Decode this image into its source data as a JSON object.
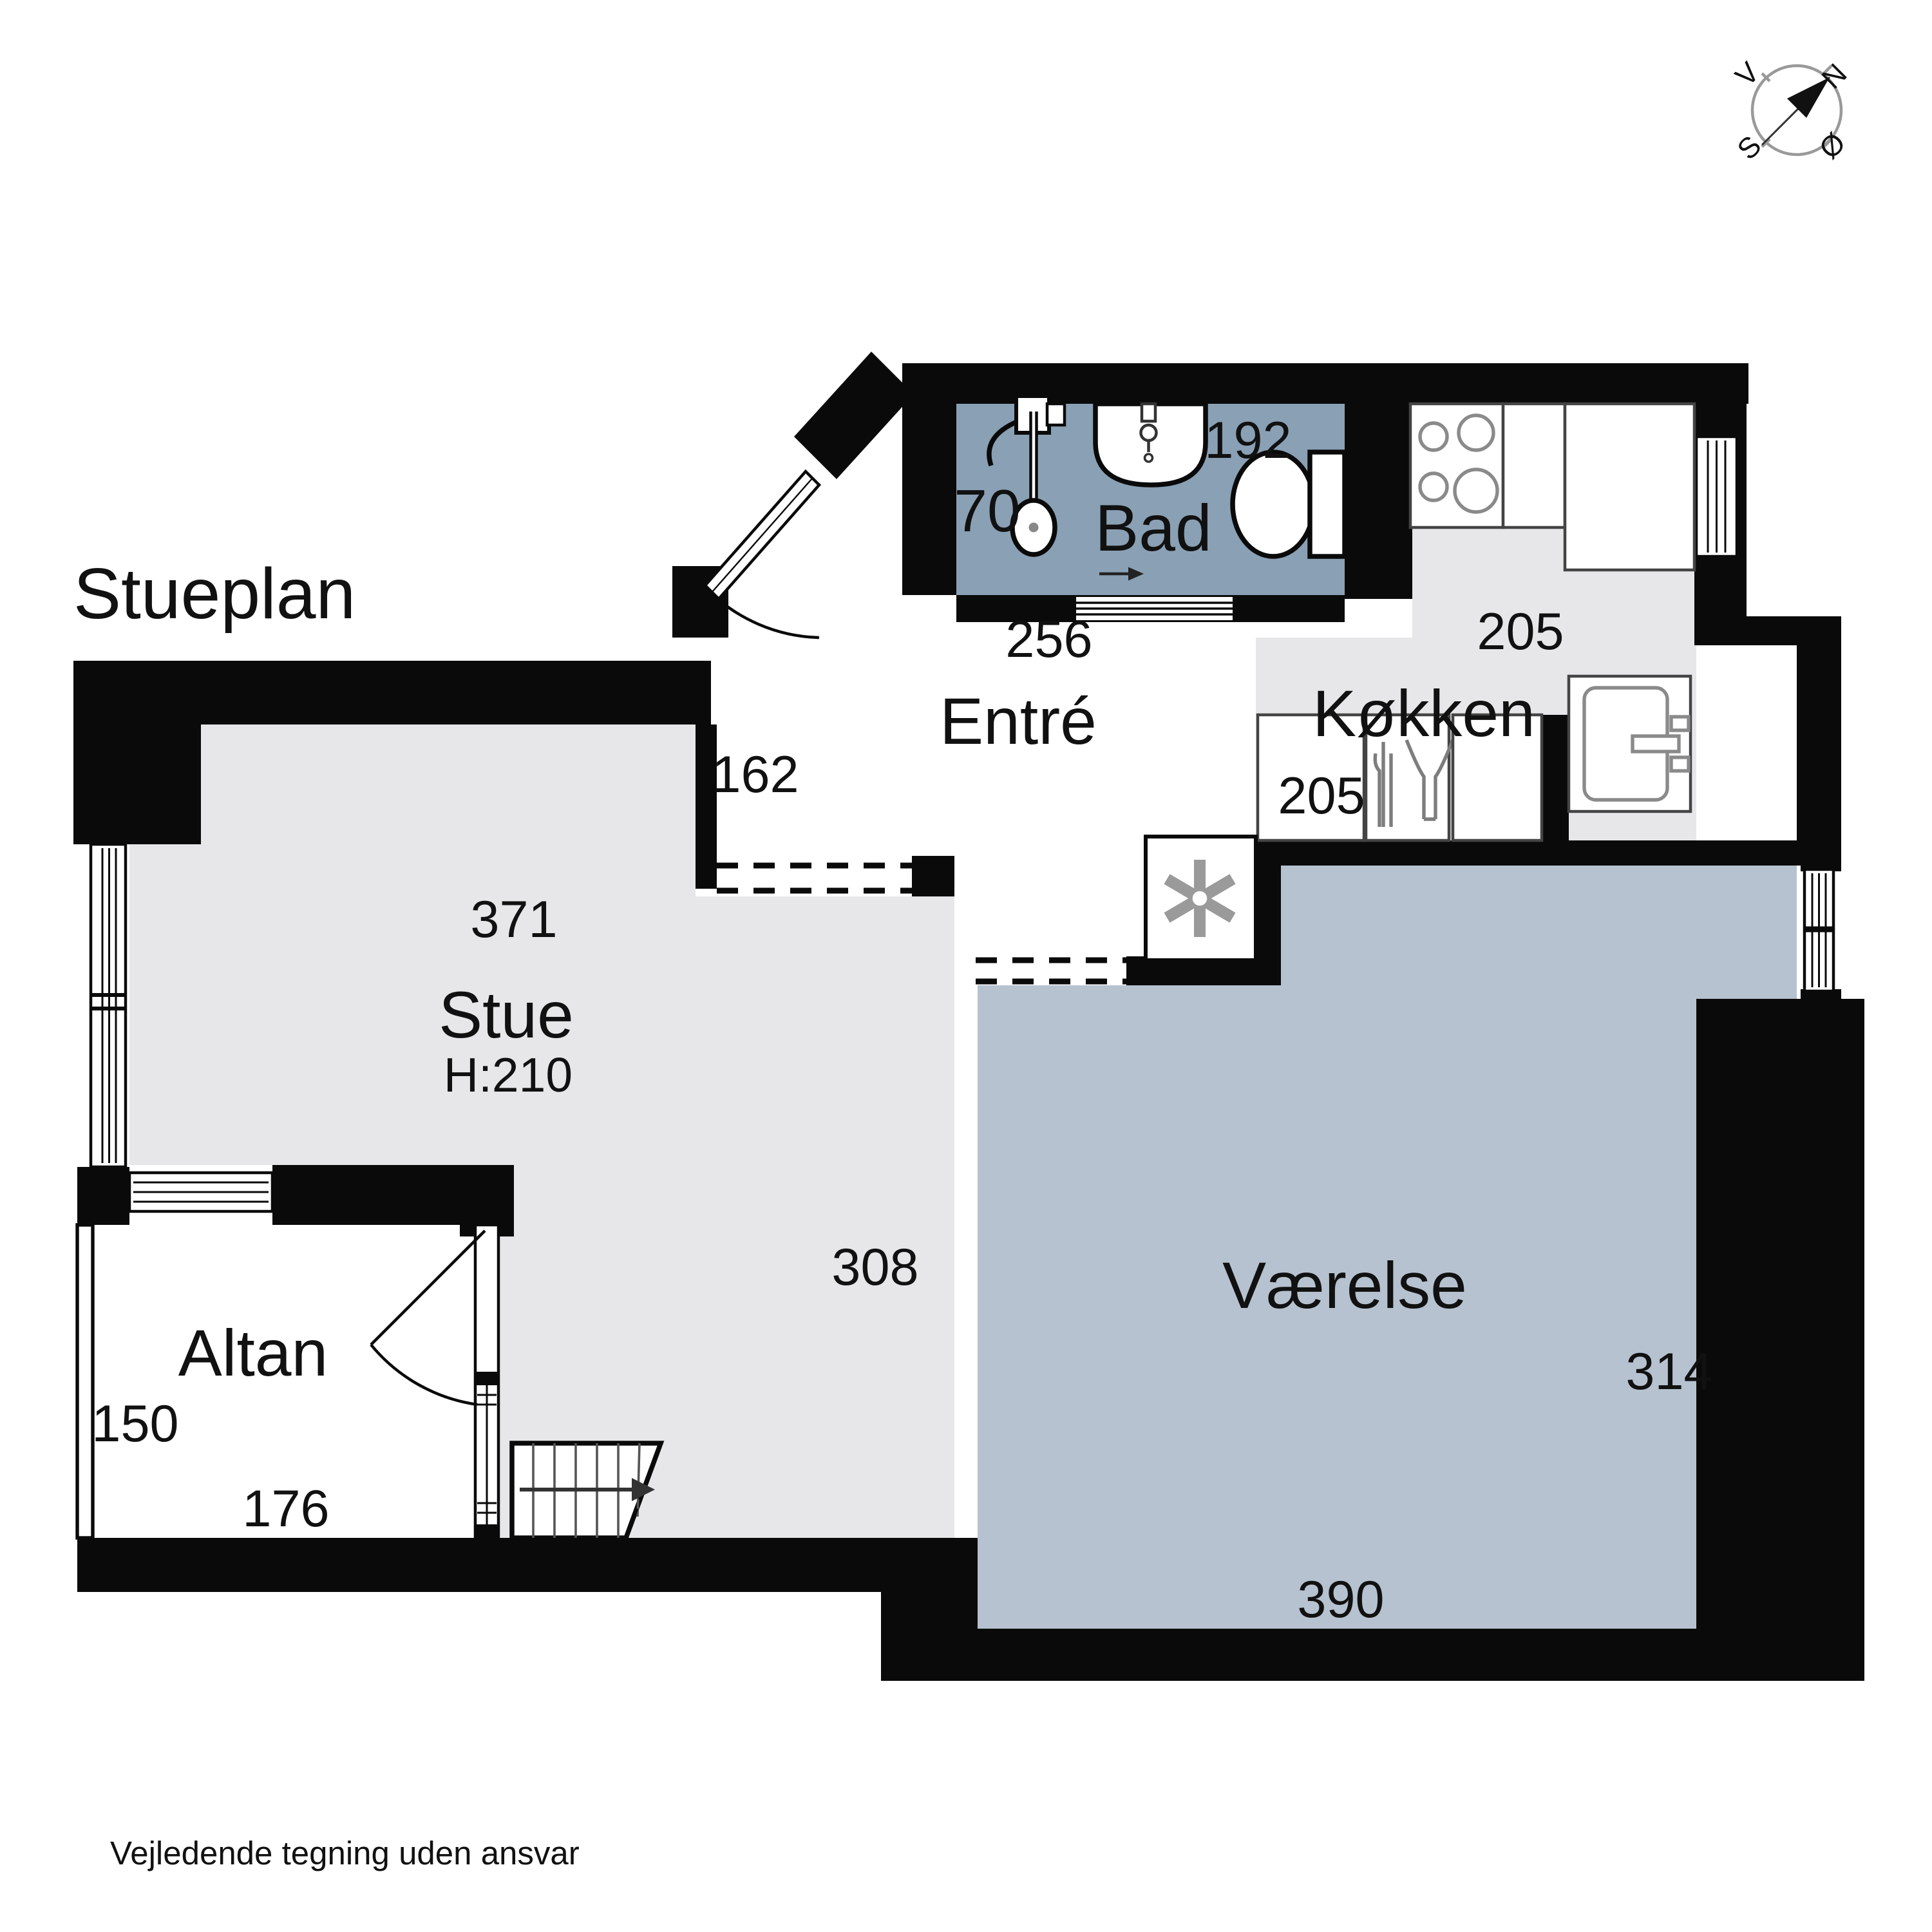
{
  "title": "Stueplan",
  "footer": "Vejledende tegning uden ansvar",
  "compass": {
    "north": "N",
    "south": "S",
    "east": "Ø",
    "west": "V"
  },
  "colors": {
    "wall": "#0a0a0a",
    "bad_floor": "#8aa0b4",
    "vaerelse_floor": "#b6c2cf",
    "stue_floor": "#e7e7e9",
    "kokken_floor": "#e7e7e9",
    "outside": "#ffffff"
  },
  "rooms": {
    "bad": {
      "label": "Bad",
      "dim_width": "192",
      "dim_shower": "70"
    },
    "entre": {
      "label": "Entré",
      "dim_width": "256",
      "dim_depth": "162"
    },
    "kokken": {
      "label": "Køkken",
      "dim_width": "205",
      "dim_depth": "205"
    },
    "stue": {
      "label": "Stue",
      "ceiling_height": "H:210",
      "dim_width": "371",
      "dim_depth": "308"
    },
    "vaerelse": {
      "label": "Værelse",
      "dim_width": "390",
      "dim_depth": "314"
    },
    "altan": {
      "label": "Altan",
      "dim_width": "176",
      "dim_depth": "150"
    }
  }
}
